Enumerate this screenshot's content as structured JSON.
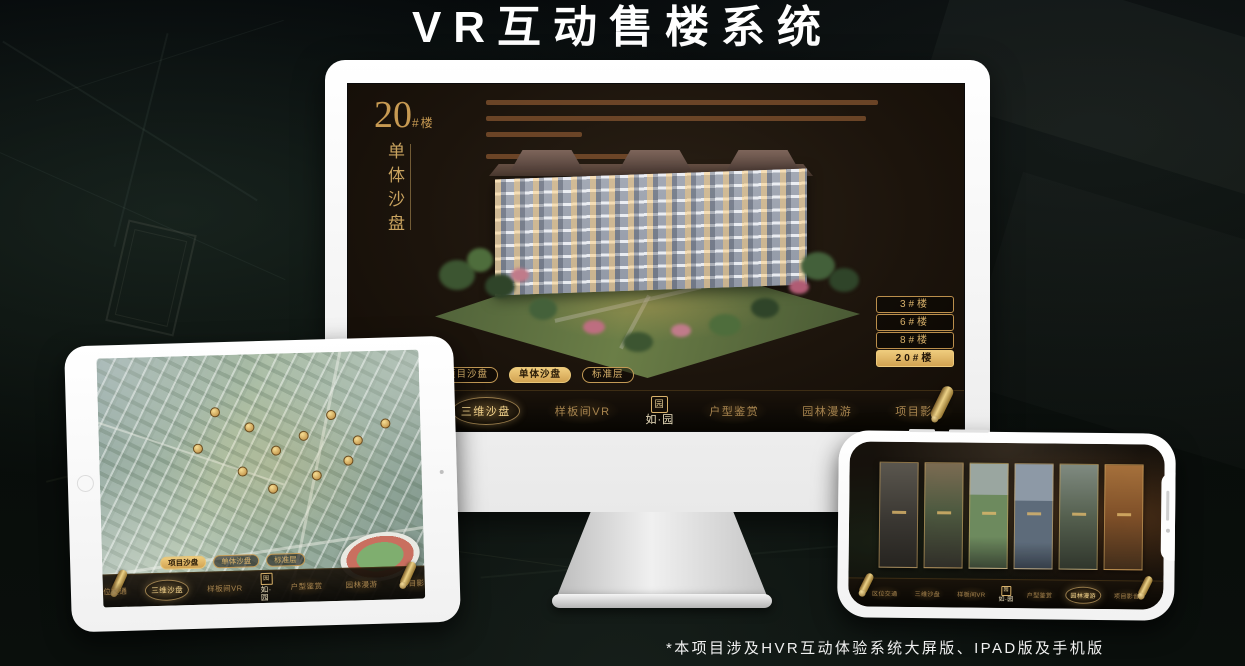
{
  "page": {
    "title": "VR互动售楼系统",
    "footnote": "*本项目涉及HVR互动体验系统大屏版、IPAD版及手机版"
  },
  "colors": {
    "gold": "#d9b26b",
    "gold_highlight": "#eecb7c",
    "nav_text": "#a8854f",
    "screen_bg": "#1c140c"
  },
  "project_logo": {
    "seal_char": "园",
    "name": "如·园"
  },
  "monitor": {
    "unit_number": "20",
    "unit_suffix": "#楼",
    "unit_subtitle_vertical": "单体沙盘",
    "floor_buttons": [
      {
        "label": "3#楼",
        "active": false
      },
      {
        "label": "6#楼",
        "active": false
      },
      {
        "label": "8#楼",
        "active": false
      },
      {
        "label": "20#楼",
        "active": true
      }
    ],
    "sub_tabs": [
      {
        "label": "项目沙盘",
        "active": false
      },
      {
        "label": "单体沙盘",
        "active": true
      },
      {
        "label": "标准层",
        "active": false
      }
    ]
  },
  "navs": {
    "monitor": {
      "items": [
        {
          "label": "区位交通",
          "active": false
        },
        {
          "label": "三维沙盘",
          "active": true
        },
        {
          "label": "样板间VR",
          "active": false
        },
        {
          "label": "户型鉴赏",
          "active": false
        },
        {
          "label": "园林漫游",
          "active": false
        },
        {
          "label": "项目影音",
          "active": false
        }
      ]
    },
    "ipad": {
      "items": [
        {
          "label": "区位交通",
          "active": false
        },
        {
          "label": "三维沙盘",
          "active": true
        },
        {
          "label": "样板间VR",
          "active": false
        },
        {
          "label": "户型鉴赏",
          "active": false
        },
        {
          "label": "园林漫游",
          "active": false
        },
        {
          "label": "项目影音",
          "active": false
        }
      ]
    },
    "phone": {
      "items": [
        {
          "label": "区位交通",
          "active": false
        },
        {
          "label": "三维沙盘",
          "active": false
        },
        {
          "label": "样板间VR",
          "active": false
        },
        {
          "label": "户型鉴赏",
          "active": false
        },
        {
          "label": "园林漫游",
          "active": true
        },
        {
          "label": "项目影音",
          "active": false
        }
      ]
    }
  },
  "ipad": {
    "sub_tabs": [
      {
        "label": "项目沙盘",
        "active": true
      },
      {
        "label": "单体沙盘",
        "active": false
      },
      {
        "label": "标准层",
        "active": false
      }
    ]
  }
}
